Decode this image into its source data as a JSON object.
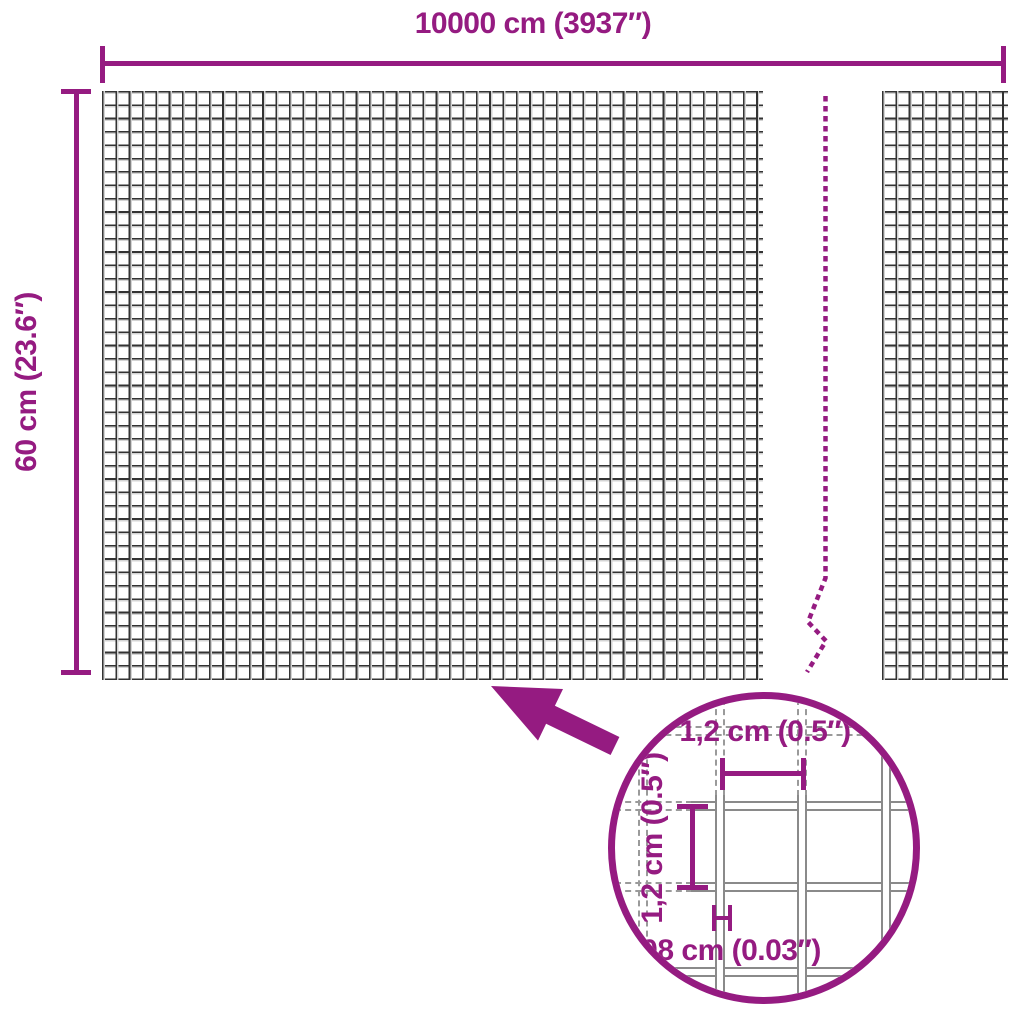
{
  "diagram": {
    "width_dimension": {
      "label": "10000 cm (3937″)"
    },
    "height_dimension": {
      "label": "60 cm (23.6″)"
    },
    "detail": {
      "cell_width": {
        "label": "1,2 cm (0.5″)"
      },
      "cell_height": {
        "label": "1,2 cm (0.5″)"
      },
      "wire_thickness": {
        "label": "0,08 cm (0.03″)"
      }
    },
    "colors": {
      "accent": "#951B81",
      "mesh_line": "#333333",
      "mesh_line_light": "#D4D4D4",
      "detail_wire_outline": "#8A8A8A"
    }
  }
}
